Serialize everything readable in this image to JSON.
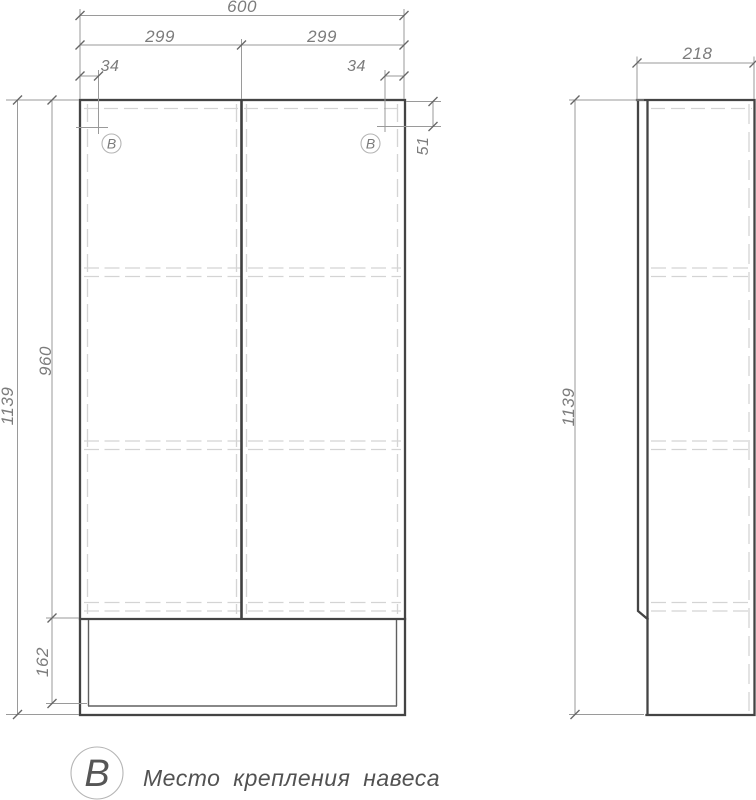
{
  "drawing": {
    "type": "furniture technical drawing, front and side views of a two-door wall cabinet",
    "colors": {
      "background": "#ffffff",
      "outline": "#444444",
      "hidden_line": "#d4d4d4",
      "dimension_line": "#9a9a9a",
      "dimension_text": "#7c7c7c",
      "legend_text": "#525252"
    }
  },
  "front_view": {
    "dims": {
      "total_width": "600",
      "door_left_width": "299",
      "door_right_width": "299",
      "mount_offset_left": "34",
      "mount_offset_right": "34",
      "mount_offset_top": "51",
      "door_height": "960",
      "total_height": "1139",
      "bottom_section_height": "162"
    },
    "mount_left_label": "В",
    "mount_right_label": "В"
  },
  "side_view": {
    "dims": {
      "total_depth": "218",
      "total_height": "1139"
    }
  },
  "legend": {
    "symbol": "В",
    "text": "Место крепления навеса"
  }
}
